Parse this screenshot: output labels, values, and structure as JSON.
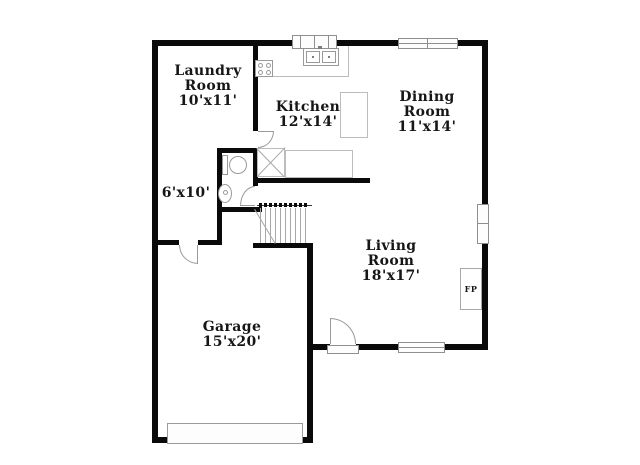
{
  "colors": {
    "wall": "#0a0a0a",
    "counter": "#bcbcbc",
    "plumbing": "#9a9a9a",
    "window": "#8f8f8f",
    "text": "#161616",
    "bg": "#ffffff"
  },
  "rooms": {
    "laundry": {
      "lines": [
        "Laundry",
        "Room",
        "10'x11'"
      ]
    },
    "kitchen": {
      "lines": [
        "Kitchen",
        "12'x14'"
      ]
    },
    "dining": {
      "lines": [
        "Dining",
        "Room",
        "11'x14'"
      ]
    },
    "hall": {
      "lines": [
        "6'x10'"
      ]
    },
    "living": {
      "lines": [
        "Living",
        "Room",
        "18'x17'"
      ]
    },
    "garage": {
      "lines": [
        "Garage",
        "15'x20'"
      ]
    }
  },
  "fixtures": {
    "fireplace_label": "FP",
    "items": [
      "range-stove",
      "kitchen-sink",
      "kitchen-island",
      "kitchen-counter",
      "pantry-closet-x",
      "toilet",
      "pedestal-sink",
      "staircase",
      "fireplace",
      "garage-door",
      "front-door",
      "interior-doors",
      "windows"
    ]
  }
}
